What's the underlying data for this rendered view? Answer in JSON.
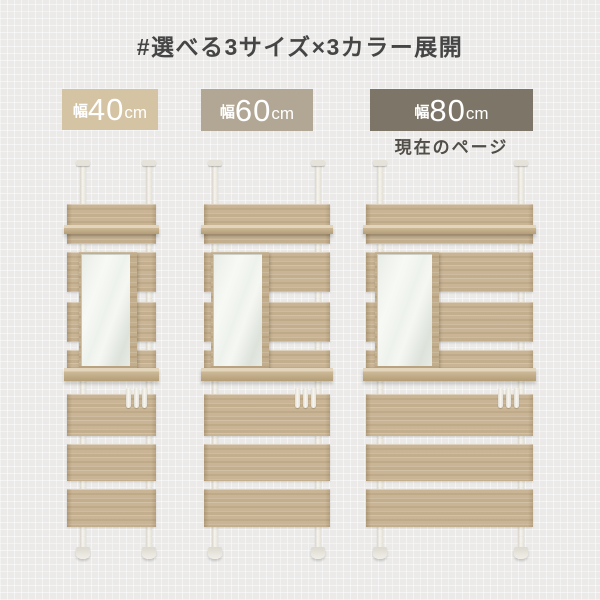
{
  "page": {
    "title": "#選べる3サイズ×3カラー展開",
    "background_color": "#ebeae8",
    "title_color": "#454545"
  },
  "sizes": [
    {
      "id": "40cm",
      "prefix": "幅",
      "value": "40",
      "unit": "cm",
      "badge_color": "#d5c4a4",
      "current": false
    },
    {
      "id": "60cm",
      "prefix": "幅",
      "value": "60",
      "unit": "cm",
      "badge_color": "#b2a795",
      "current": false
    },
    {
      "id": "80cm",
      "prefix": "幅",
      "value": "80",
      "unit": "cm",
      "badge_color": "#7d7567",
      "current": true,
      "current_label": "現在のページ"
    }
  ],
  "badge_text_color": "#ffffff",
  "current_label_color": "#514e48",
  "product": {
    "description_parts": [
      "tension-pole-wall-shelf",
      "mirror",
      "hooks"
    ],
    "wood_color": "#c9b595",
    "pole_color": "#f6f4ee"
  }
}
